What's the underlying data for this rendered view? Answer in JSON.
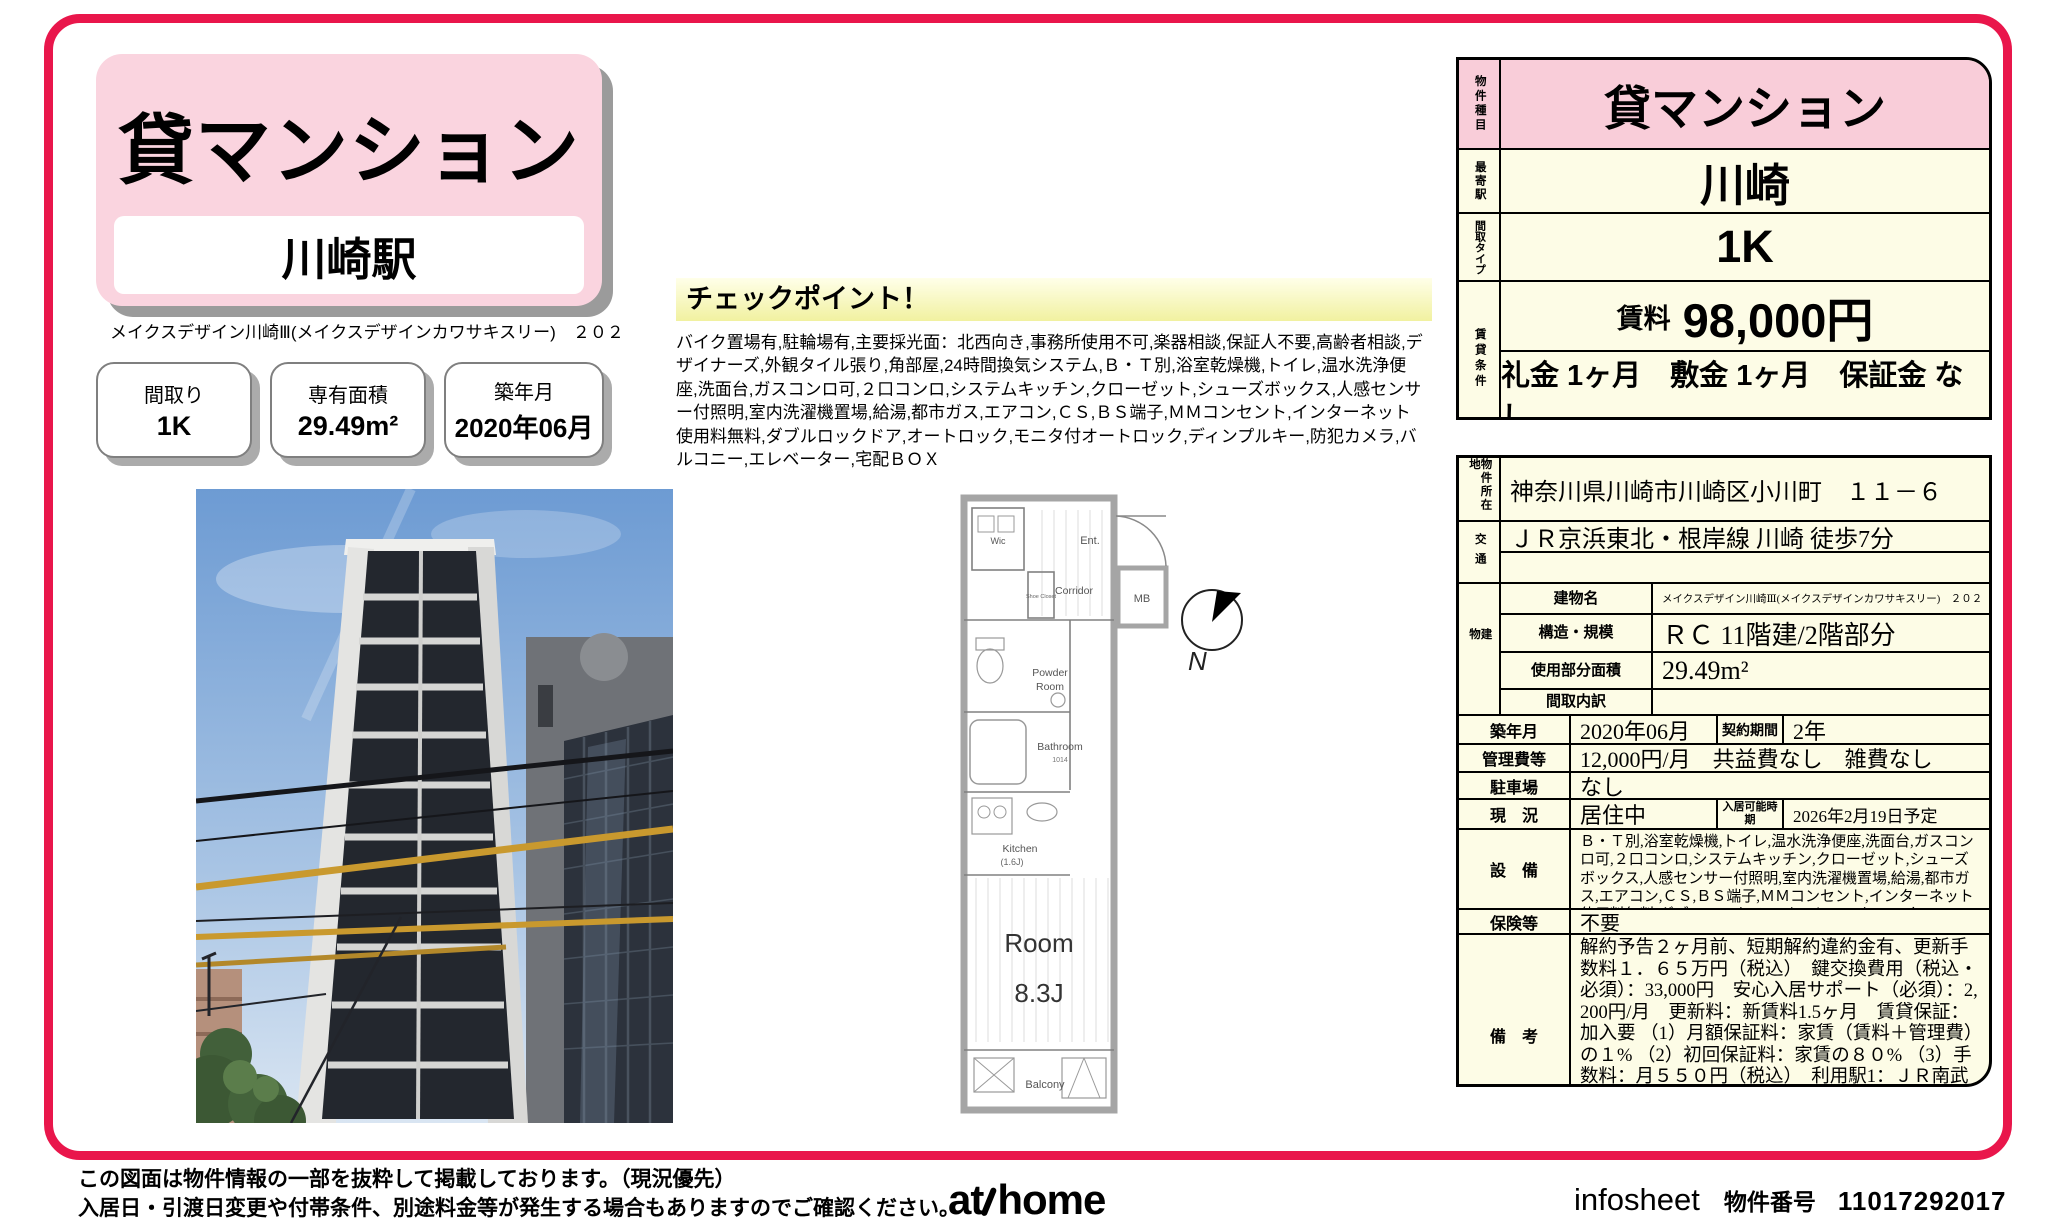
{
  "colors": {
    "frame": "#e9164b",
    "title_pink": "#fad4df",
    "cell_pink": "#f9cdd9",
    "cell_cream": "#fdfce6",
    "checkpoint_yellow": "#f1f1a0"
  },
  "title_card": {
    "category": "貸マンション",
    "station": "川崎駅"
  },
  "building_line": "メイクスデザイン川崎Ⅲ(メイクスデザインカワサキスリー)　２０２",
  "spec_boxes": [
    {
      "label": "間取り",
      "value": "1K"
    },
    {
      "label": "専有面積",
      "value": "29.49m²"
    },
    {
      "label": "築年月",
      "value": "2020年06月"
    }
  ],
  "checkpoint": {
    "title": "チェックポイント！",
    "body": "バイク置場有,駐輪場有,主要採光面：北西向き,事務所使用不可,楽器相談,保証人不要,高齢者相談,デザイナーズ,外観タイル張り,角部屋,24時間換気システム,Ｂ・Ｔ別,浴室乾燥機,トイレ,温水洗浄便座,洗面台,ガスコンロ可,２口コンロ,システムキッチン,クローゼット,シューズボックス,人感センサー付照明,室内洗濯機置場,給湯,都市ガス,エアコン,ＣＳ,ＢＳ端子,ＭＭコンセント,インターネット使用料無料,ダブルロックドア,オートロック,モニタ付オートロック,ディンプルキー,防犯カメラ,バルコニー,エレベーター,宅配ＢＯＸ"
  },
  "floorplan": {
    "wic": "Wic",
    "shoe_closet": "Shoe Closet",
    "ent": "Ent.",
    "corridor": "Corridor",
    "mb": "MB",
    "powder1": "Powder",
    "powder2": "Room",
    "bathroom": "Bathroom",
    "bathroom_size": "1014",
    "kitchen": "Kitchen",
    "kitchen_size": "(1.6J)",
    "room": "Room",
    "room_size": "8.3J",
    "balcony": "Balcony",
    "compass": "N"
  },
  "summary": {
    "type_label": "物件種目",
    "type": "貸マンション",
    "station_label": "最寄駅",
    "station": "川崎",
    "layout_label": "間取タイプ",
    "layout": "1K",
    "terms_label": "賃貸条件",
    "rent_label": "賃料",
    "rent": "98,000円",
    "terms": "礼金 1ヶ月　敷金 1ヶ月　保証金 なし"
  },
  "detail": {
    "address_label": "物件所在地",
    "address": "神奈川県川崎市川崎区小川町　１１－６",
    "access_label": "交通",
    "access1": "ＪＲ京浜東北・根岸線 川崎 徒歩7分",
    "access2": "",
    "building_label": "建物",
    "bname_label": "建物名",
    "bname": "メイクスデザイン川崎Ⅲ(メイクスデザインカワサキスリー)　２０２",
    "structure_label": "構造・規模",
    "structure": "ＲＣ 11階建/2階部分",
    "area_label": "使用部分面積",
    "area": "29.49m²",
    "madori_label": "間取内訳",
    "madori": "",
    "built_label": "築年月",
    "built": "2020年06月",
    "contract_label": "契約期間",
    "contract": "2年",
    "fees_label": "管理費等",
    "fees": "12,000円/月　共益費なし　雑費なし",
    "parking_label": "駐車場",
    "parking": "なし",
    "status_label": "現　況",
    "status": "居住中",
    "movein_label": "入居可能時期",
    "movein": "2026年2月19日予定",
    "equipment_label": "設　備",
    "equipment": "Ｂ・Ｔ別,浴室乾燥機,トイレ,温水洗浄便座,洗面台,ガスコンロ可,２口コンロ,システムキッチン,クローゼット,シューズボックス,人感センサー付照明,室内洗濯機置場,給湯,都市ガス,エアコン,ＣＳ,ＢＳ端子,ＭＭコンセント,インターネット使用料無料,ダブルロックドア,オートロック,モニタ...",
    "insurance_label": "保険等",
    "insurance": "不要",
    "notes_label": "備　考",
    "notes": "解約予告２ヶ月前、短期解約違約金有、更新手数料１．６５万円（税込）　鍵交換費用（税込・必須）：33,000円　安心入居サポート（必須）：2,200円/月　更新料：新賃料1.5ヶ月　賃貸保証：加入要 （1）月額保証料：家賃（賃料＋管理費）の１% （2）初回保証料：家賃の８０% （3）手数料：月５５０円（税込）　利用駅1：ＪＲ南武線 川崎 徒歩7分　利用駅2：ＪＲ東海道本線 川崎 徒歩7分"
  },
  "footer": {
    "disclaimer1": "この図面は物件情報の一部を抜粋して掲載しております。（現況優先）",
    "disclaimer2": "入居日・引渡日変更や付帯条件、別途料金等が発生する場合もありますのでご確認ください。",
    "logo_at": "at",
    "logo_home": "home",
    "infosheet": "infosheet",
    "pno_label": "物件番号",
    "pno": "11017292017"
  }
}
